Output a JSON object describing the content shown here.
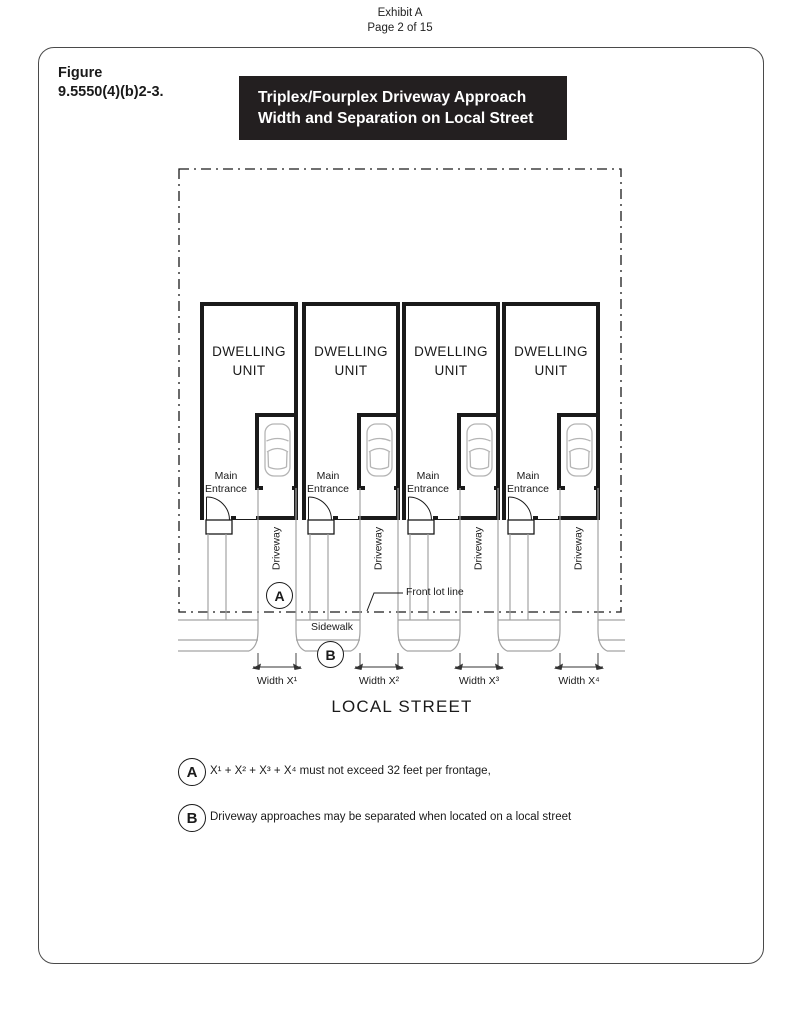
{
  "page": {
    "exhibit": "Exhibit A",
    "page_number": "Page 2 of 15"
  },
  "figure": {
    "label": "Figure\n9.5550(4)(b)2-3.",
    "title": "Triplex/Fourplex Driveway Approach\nWidth and Separation on Local Street",
    "banner_bg": "#231f20",
    "banner_fg": "#ffffff"
  },
  "diagram": {
    "units": [
      {
        "dwelling": "DWELLING\nUNIT",
        "entrance": "Main\nEntrance",
        "driveway": "Driveway",
        "width": "Width X¹"
      },
      {
        "dwelling": "DWELLING\nUNIT",
        "entrance": "Main\nEntrance",
        "driveway": "Driveway",
        "width": "Width X²"
      },
      {
        "dwelling": "DWELLING\nUNIT",
        "entrance": "Main\nEntrance",
        "driveway": "Driveway",
        "width": "Width X³"
      },
      {
        "dwelling": "DWELLING\nUNIT",
        "entrance": "Main\nEntrance",
        "driveway": "Driveway",
        "width": "Width X⁴"
      }
    ],
    "labels": {
      "front_lot_line": "Front lot line",
      "sidewalk": "Sidewalk",
      "street": "LOCAL STREET",
      "marker_a": "A",
      "marker_b": "B"
    },
    "colors": {
      "lines": "#1a1a1a",
      "gray": "#a3a3a3"
    }
  },
  "notes": [
    {
      "marker": "A",
      "text": "X¹ + X² + X³ +  X⁴  must not exceed 32 feet per frontage,"
    },
    {
      "marker": "B",
      "text": "Driveway approaches may be separated when located on a local street"
    }
  ]
}
